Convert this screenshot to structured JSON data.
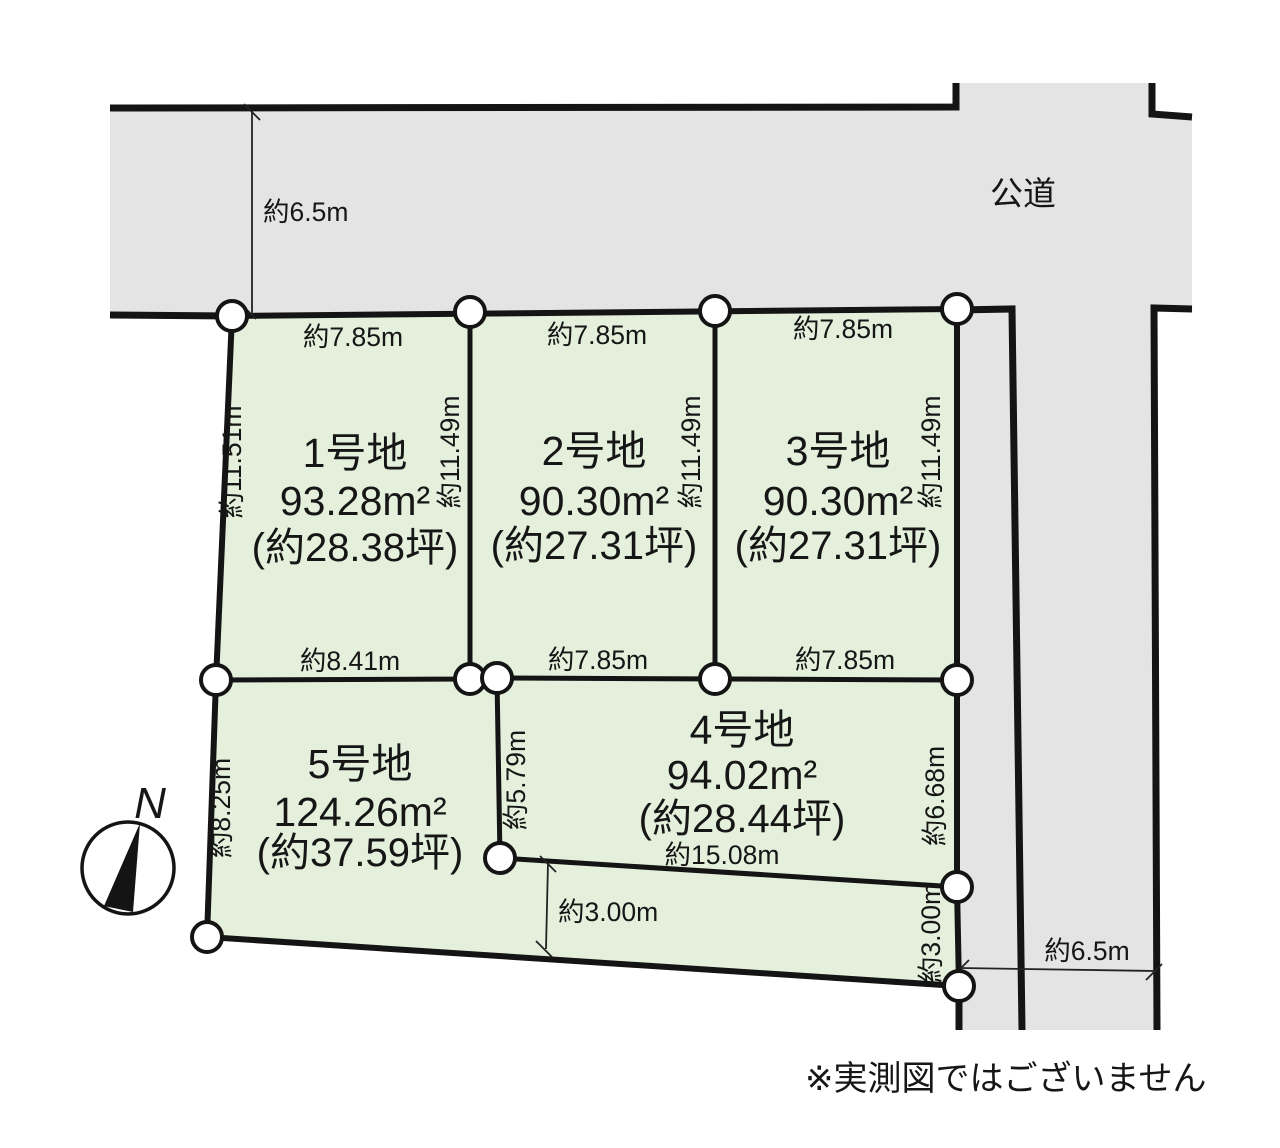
{
  "diagram": {
    "road_label": "公道",
    "compass_label": "N",
    "disclaimer": "※実測図ではございません",
    "colors": {
      "road_fill": "#e4e4e4",
      "plot_fill": "#e4f0dc",
      "line": "#141414",
      "background": "#ffffff"
    },
    "plots": [
      {
        "label": "1号地",
        "area": "93.28m²",
        "tsubo": "(約28.38坪)"
      },
      {
        "label": "2号地",
        "area": "90.30m²",
        "tsubo": "(約27.31坪)"
      },
      {
        "label": "3号地",
        "area": "90.30m²",
        "tsubo": "(約27.31坪)"
      },
      {
        "label": "4号地",
        "area": "94.02m²",
        "tsubo": "(約28.44坪)"
      },
      {
        "label": "5号地",
        "area": "124.26m²",
        "tsubo": "(約37.59坪)"
      }
    ],
    "dims": {
      "road_top_width": "約6.5m",
      "road_right_width": "約6.5m",
      "p1_top": "約7.85m",
      "p2_top": "約7.85m",
      "p3_top": "約7.85m",
      "p1_left": "約11.51m",
      "p1_p2_boundary": "約11.49m",
      "p2_p3_boundary": "約11.49m",
      "p3_right": "約11.49m",
      "p1_bottom": "約8.41m",
      "p2_bottom": "約7.85m",
      "p3_bottom": "約7.85m",
      "p4_left": "約5.79m",
      "p4_right": "約6.68m",
      "p4_bottom": "約15.08m",
      "p5_left": "約8.25m",
      "strip_width": "約3.00m",
      "strip_right": "約3.00m"
    }
  }
}
